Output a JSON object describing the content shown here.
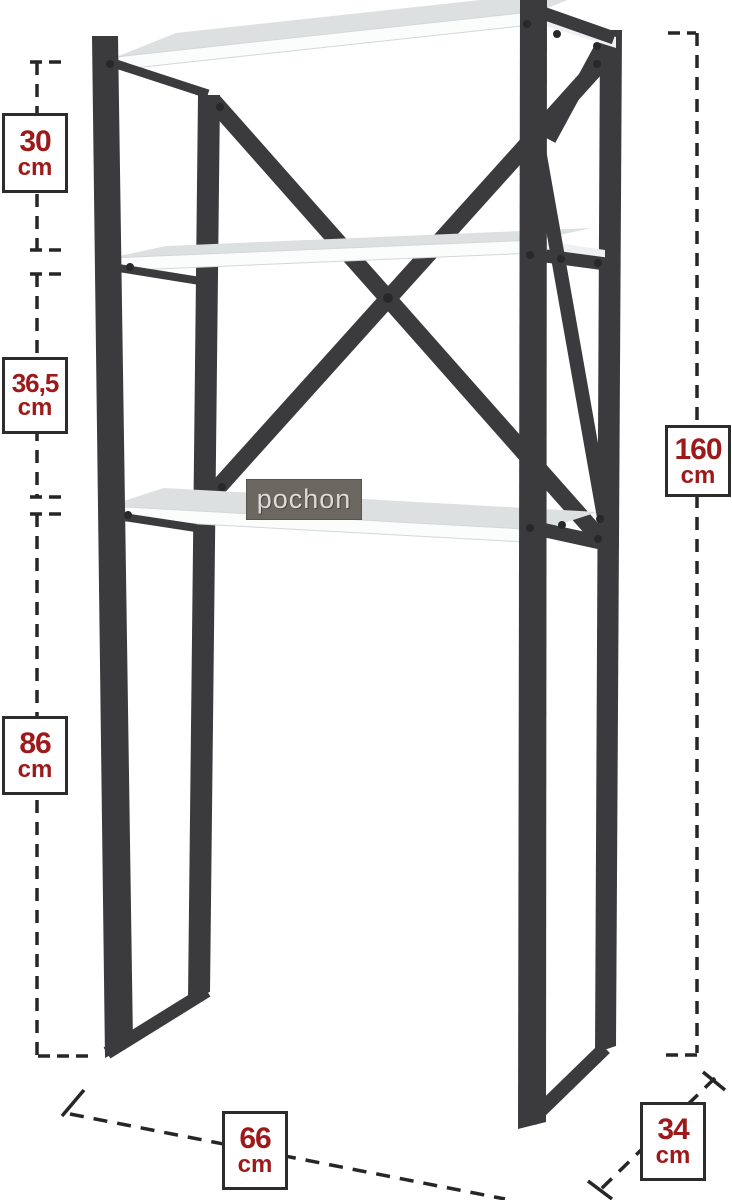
{
  "illustration": {
    "brand_label": "pochon",
    "frame_color": "#3b3b3d",
    "shelf_top_color": "#dce0e1",
    "shelf_edge_color": "#fbfcfc",
    "label_bg_color": "#6a6861"
  },
  "dimensions": {
    "accent_color": "#9e1a1a",
    "left": [
      {
        "value": "30",
        "unit": "cm"
      },
      {
        "value": "36,5",
        "unit": "cm"
      },
      {
        "value": "86",
        "unit": "cm"
      }
    ],
    "right": [
      {
        "value": "160",
        "unit": "cm"
      }
    ],
    "bottom": [
      {
        "value": "66",
        "unit": "cm"
      },
      {
        "value": "34",
        "unit": "cm"
      }
    ]
  }
}
